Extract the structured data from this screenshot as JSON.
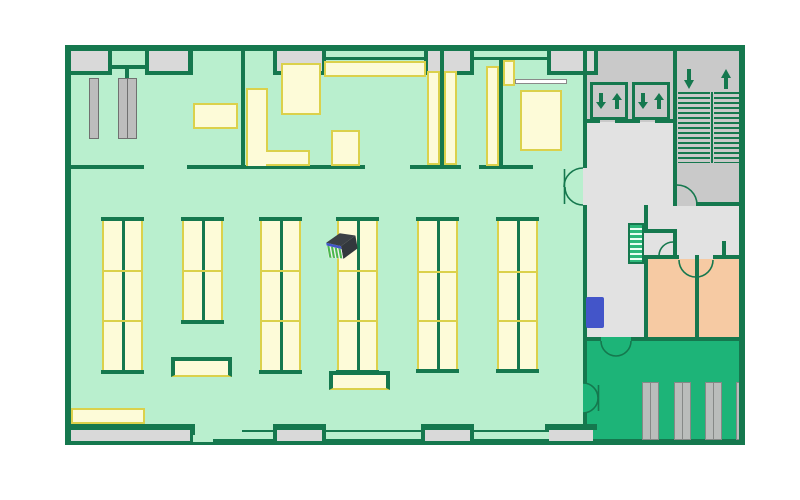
{
  "palette": {
    "wall": "#15784e",
    "floor": "#b9efce",
    "zoneGreen": "#1db478",
    "corridorGray": "#e2e2e2",
    "lobbyGray": "#c9c9c9",
    "windowFill": "#d9d9d9",
    "roomPeach": "#f6caa3",
    "shelfFill": "#fdfbd8",
    "shelfLine": "#dbd14b",
    "pillarFill": "#bdbdbd",
    "pillarLine": "#707070",
    "barFill": "#babdbb",
    "barLine": "#868987",
    "markerBlue": "#4355c9",
    "markerDark": "#3b4046",
    "markerSide": "#33383d",
    "markerGreen": "#4cb84e",
    "markerFace": "#f2f2f2",
    "kioskBlue": "#4355c9",
    "miniStairs": "#2db87a",
    "lightBar": "#ffffff"
  },
  "icons": {
    "elevator": "down-up-arrows",
    "stairs_down": "down-arrow",
    "stairs_up": "up-arrow",
    "marker": "shelf-rack-3d"
  }
}
